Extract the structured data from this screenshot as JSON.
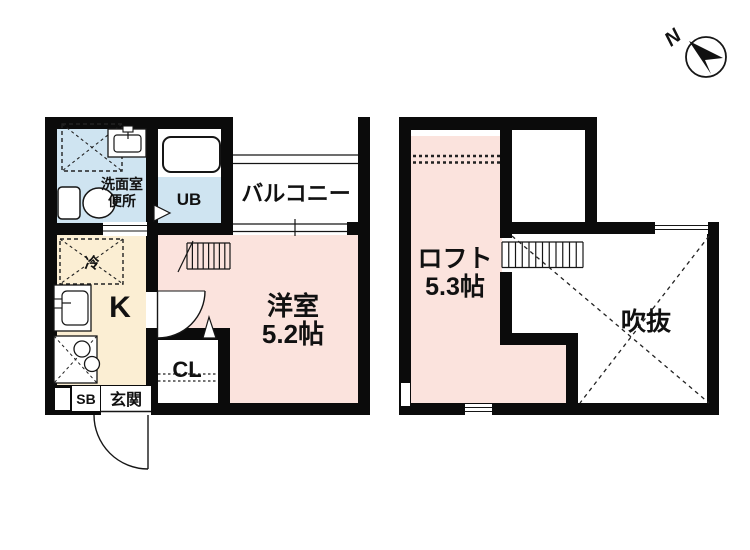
{
  "colors": {
    "wall": "#0b0b0b",
    "room_pink": "#fbe3dd",
    "room_blue": "#cfe4f1",
    "room_cream": "#fbeed3",
    "line": "#161616"
  },
  "floor1": {
    "washroom_line1": "洗面室",
    "washroom_line2": "便所",
    "unit_bath": "UB",
    "balcony": "バルコニー",
    "western_room": "洋室",
    "western_room_size": "5.2帖",
    "kitchen": "K",
    "refrigerator": "冷",
    "closet": "CL",
    "shoe_box": "SB",
    "entrance": "玄関"
  },
  "floor2": {
    "loft": "ロフト",
    "loft_size": "5.3帖",
    "void": "吹抜"
  },
  "compass": {
    "north": "N"
  }
}
